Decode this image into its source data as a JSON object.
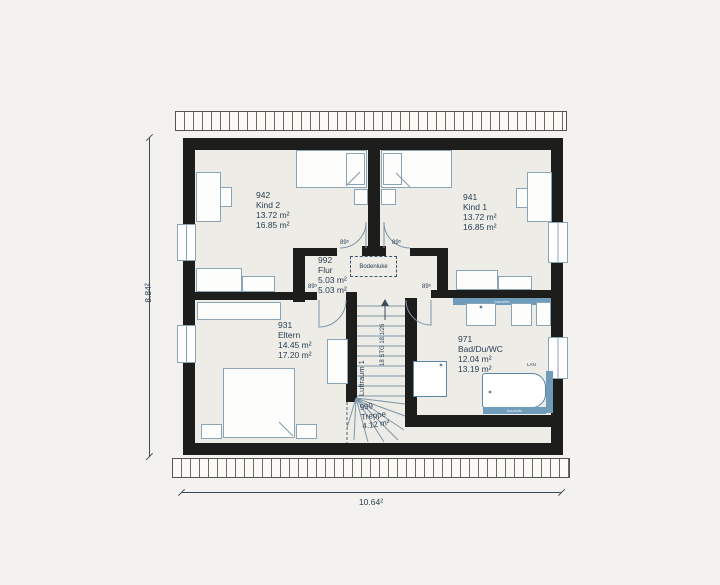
{
  "dims": {
    "height_label": "8.84²",
    "width_label": "10.64²"
  },
  "rooms": [
    {
      "id": "942",
      "name": "Kind 2",
      "area1": "13.72 m²",
      "area2": "16.85 m²"
    },
    {
      "id": "941",
      "name": "Kind 1",
      "area1": "13.72 m²",
      "area2": "16.85 m²"
    },
    {
      "id": "992",
      "name": "Flur",
      "area1": "5.03 m²",
      "area2": "5.03 m²"
    },
    {
      "id": "931",
      "name": "Eltern",
      "area1": "14.45 m²",
      "area2": "17.20 m²"
    },
    {
      "id": "971",
      "name": "Bad/Du/WC",
      "area1": "12.04 m²",
      "area2": "13.19 m²"
    },
    {
      "id": "999",
      "name": "Treppe",
      "area1": "4.12 m²"
    }
  ],
  "annotations": {
    "bodenluke": "Bodenluke",
    "luftraum": "Luftraum 1",
    "stairs_spec": "18 STG 18.1/26",
    "door_width": "89⁵",
    "lan": "LAN",
    "bauseits": "bauseits"
  },
  "colors": {
    "wall": "#1d1d1b",
    "floor": "#edece6",
    "linework": "#8ba4b5",
    "fixture_blue": "#6f9cba",
    "text": "#2c4156"
  }
}
